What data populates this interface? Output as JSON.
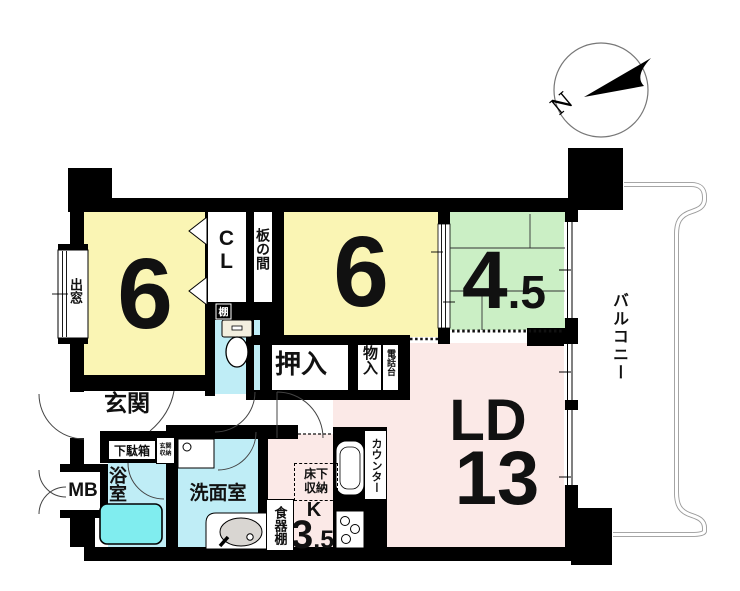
{
  "compass": {
    "north_label": "N"
  },
  "balcony": {
    "label": "バルコニー"
  },
  "rooms": {
    "bedroom_left": {
      "size": "6"
    },
    "bedroom_center": {
      "size": "6"
    },
    "tatami_room": {
      "size_int": "4",
      "size_dec": ".5"
    },
    "living_dining": {
      "name": "LD",
      "size": "13"
    },
    "kitchen": {
      "name": "K",
      "size_int": "3",
      "size_dec": ".5"
    }
  },
  "features": {
    "bay_window": "出窓",
    "closet": "CL",
    "wood_floor": "板の間",
    "oshiire": "押入",
    "storage": "物入",
    "phone_stand": "電話台",
    "counter": "カウンター",
    "underfloor_storage": "床下収納",
    "cupboard": "食器棚",
    "entrance": "玄関",
    "shoe_cabinet": "下駄箱",
    "entrance_storage": "玄関収納",
    "meter_box": "MB",
    "bathroom": "浴室",
    "washroom": "洗面室",
    "shelf": "棚"
  },
  "colors": {
    "wall": "#000000",
    "room_yellow": "#FAF5B4",
    "room_green": "#CBEFC5",
    "room_pink": "#FBE9E7",
    "water_cyan": "#BFEDF6",
    "tub_cyan": "#80EDEF",
    "basin_gray": "#D9D6D2",
    "tank_cream": "#F3EFDF",
    "balcony_line": "#9A9A9A"
  }
}
